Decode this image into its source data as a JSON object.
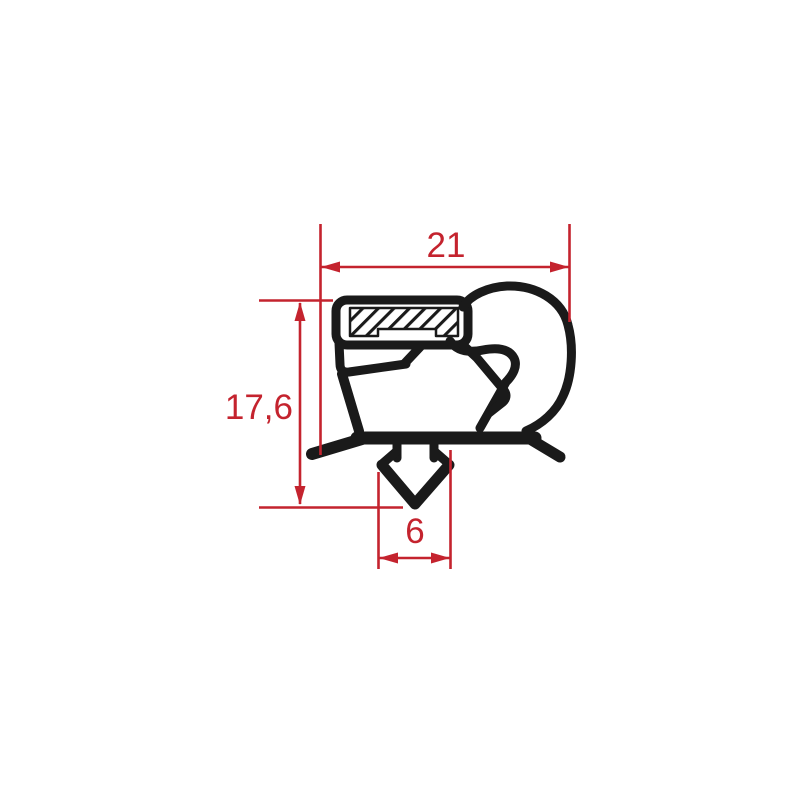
{
  "colors": {
    "background": "#ffffff",
    "profile_stroke": "#1a1a1a",
    "dimension": "#c4232e"
  },
  "drawing": {
    "subject": "Door gasket profile cross-section",
    "dimensions": {
      "top_width": {
        "value": "21"
      },
      "left_height": {
        "value": "17,6"
      },
      "bottom_width": {
        "value": "6"
      }
    }
  }
}
